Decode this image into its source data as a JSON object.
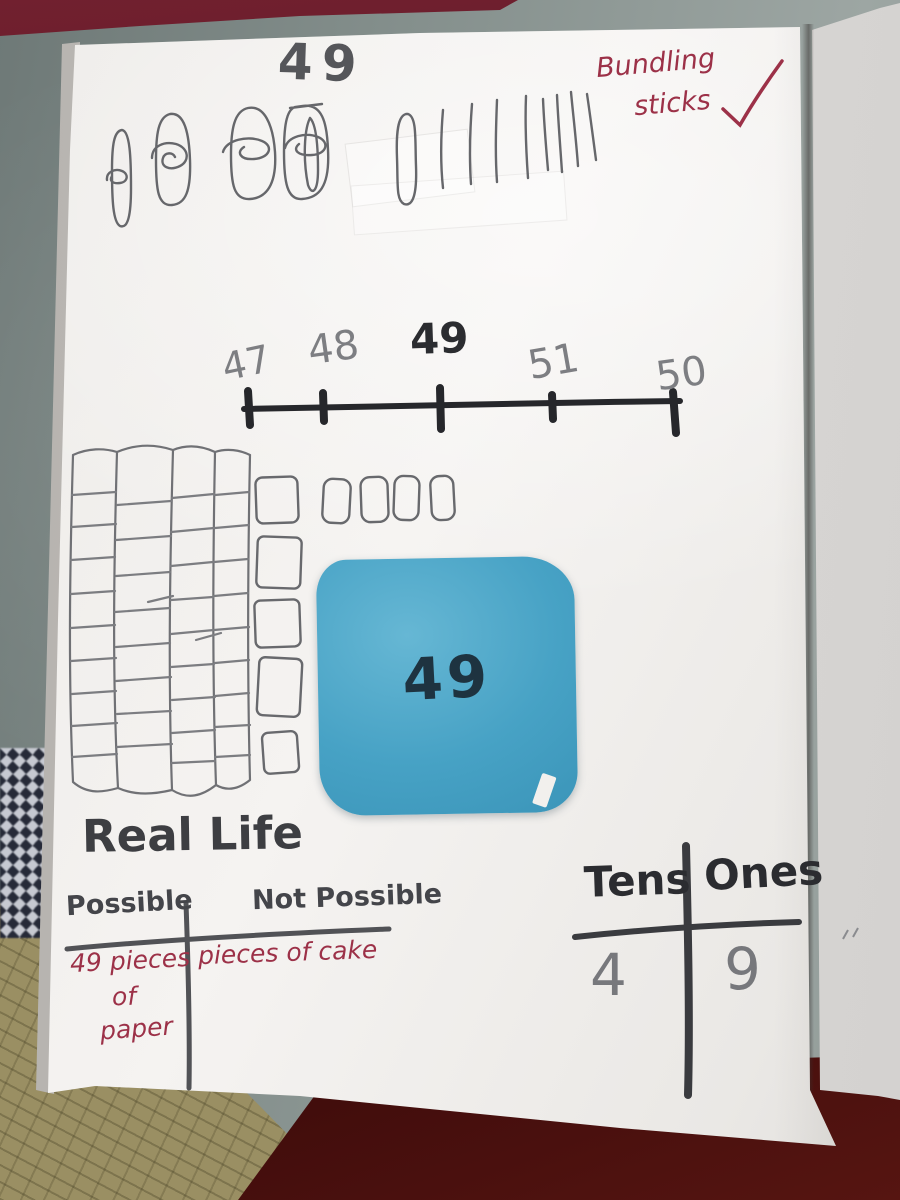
{
  "workbook": {
    "heading_number": "49",
    "annotation": {
      "line1": "Bundling",
      "line2": "sticks"
    },
    "number_line": {
      "labels": [
        "47",
        "48",
        "49",
        "51",
        "50"
      ],
      "emphasized_label": "49"
    },
    "sticky_note": {
      "value": "49"
    },
    "real_life": {
      "title": "Real Life",
      "col_possible": "Possible",
      "col_not_possible": "Not Possible",
      "possible_lines": [
        "49 pieces",
        "of",
        "paper"
      ],
      "not_possible_entry": "pieces of cake"
    },
    "place_value": {
      "col_tens": "Tens",
      "col_ones": "Ones",
      "tens_value": "4",
      "ones_value": "9"
    },
    "representations": {
      "bundles_of_ten": 4,
      "single_sticks": 9,
      "tens_rods": 4,
      "ones_blocks": 9
    }
  },
  "colors": {
    "sticky_note_blue": "#47a2c5",
    "red_pen": "#9c3148",
    "pencil_gray": "#6b6c70",
    "marker_black": "#2b2c30",
    "floor_gray": "#86918e",
    "rug_tan": "#9a8f63",
    "red_fabric": "#571210",
    "maroon_object": "#531220"
  }
}
